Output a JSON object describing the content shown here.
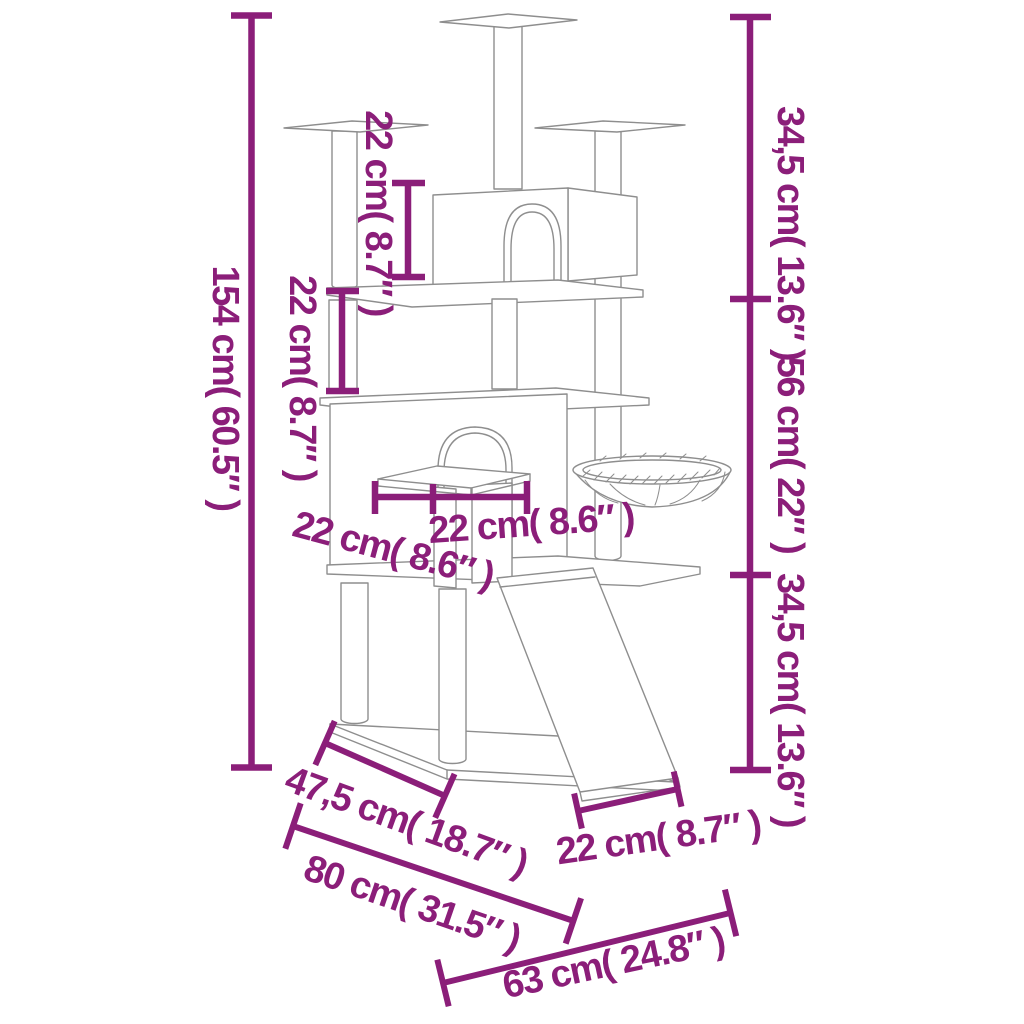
{
  "diagram": {
    "title": "Cat tree with scratching posts — dimension diagram",
    "accent_color": "#8B1E79",
    "line_color": "#8E8E8E",
    "background_color": "#FFFFFF"
  },
  "dimensions": {
    "total_height": {
      "label": "154 cm( 60.5″ )"
    },
    "top_post_height": {
      "label": "22 cm( 8.7″ )"
    },
    "mid_post_height": {
      "label": "22 cm( 8.7″ )"
    },
    "upper_section_height": {
      "label": "34,5 cm( 13.6″ )"
    },
    "middle_section_height": {
      "label": "56 cm( 22″ )"
    },
    "lower_section_height": {
      "label": "34,5 cm( 13.6″ )"
    },
    "platform_width": {
      "label": "22 cm( 8.6″ )"
    },
    "platform_depth": {
      "label": "22 cm( 8.6″ )"
    },
    "base_depth": {
      "label": "47,5 cm( 18.7″ )"
    },
    "base_width": {
      "label": "80 cm( 31.5″ )"
    },
    "ramp_width": {
      "label": "22 cm( 8.7″ )"
    },
    "footprint_depth": {
      "label": "63 cm( 24.8″ )"
    }
  }
}
